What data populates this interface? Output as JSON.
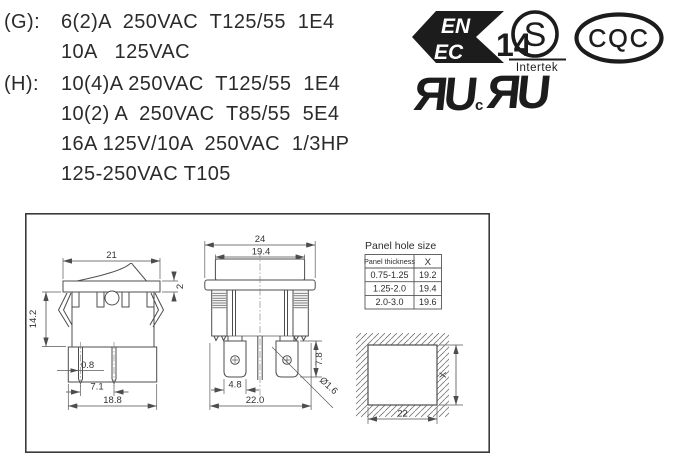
{
  "ratings": {
    "g": {
      "label": "(G):",
      "lines": [
        "6(2)A  250VAC  T125/55  1E4",
        "10A   125VAC"
      ]
    },
    "h": {
      "label": "(H):",
      "lines": [
        "10(4)A 250VAC  T125/55  1E4",
        "10(2) A  250VAC  T85/55  5E4",
        "16A 125V/10A  250VAC  1/3HP",
        "125-250VAC T105"
      ]
    }
  },
  "certs": {
    "enec": {
      "en": "EN",
      "ec": "EC",
      "number": "14"
    },
    "intertek": {
      "symbol": "S",
      "name": "Intertek"
    },
    "cqc": {
      "text": "CQC"
    },
    "ul": {
      "reversed_r": "R",
      "u": "U",
      "c": "c"
    }
  },
  "drawings": {
    "side_view": {
      "dim_width": "21",
      "dim_bezel": "2",
      "dim_height": "14.2",
      "dim_term_thk": "0.8",
      "dim_term_pitch": "7.1",
      "dim_body_width": "18.8"
    },
    "front_view": {
      "dim_bezel_width": "24",
      "dim_rocker_width": "19.4",
      "dim_term_width": "4.8",
      "dim_overall": "22.0",
      "dim_term_len": "7.8",
      "dim_hole": "Ø1.6"
    },
    "cutout": {
      "dim_width": "22",
      "dim_height": "X"
    },
    "panel_table": {
      "title": "Panel hole size",
      "col1": "Panel thickness",
      "col2": "X",
      "rows": [
        {
          "thickness": "0.75-1.25",
          "x": "19.2"
        },
        {
          "thickness": "1.25-2.0",
          "x": "19.4"
        },
        {
          "thickness": "2.0-3.0",
          "x": "19.6"
        }
      ]
    }
  }
}
